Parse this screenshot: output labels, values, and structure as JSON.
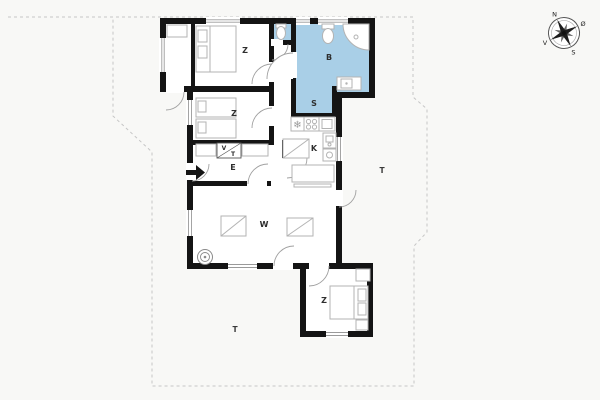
{
  "plan": {
    "rooms": {
      "bedroom_nw": "Z",
      "bedroom_w": "Z",
      "bedroom_se": "Z",
      "bathroom": "B",
      "shower_room": "S",
      "kitchen": "K",
      "entry": "E",
      "living_room": "W",
      "terrace_east": "T",
      "terrace_south": "T",
      "closet_washer": "V",
      "closet_dryer": "T"
    },
    "compass": {
      "north": "N",
      "east": "Ø",
      "south": "S",
      "west": "V"
    },
    "icons": {
      "freezer": "❄"
    },
    "colors": {
      "wet_room": "#a9cfe7",
      "wall": "#141414",
      "background": "#f8f8f6",
      "boundary": "#c6c6c6",
      "furniture": "#b3b3b3"
    }
  }
}
